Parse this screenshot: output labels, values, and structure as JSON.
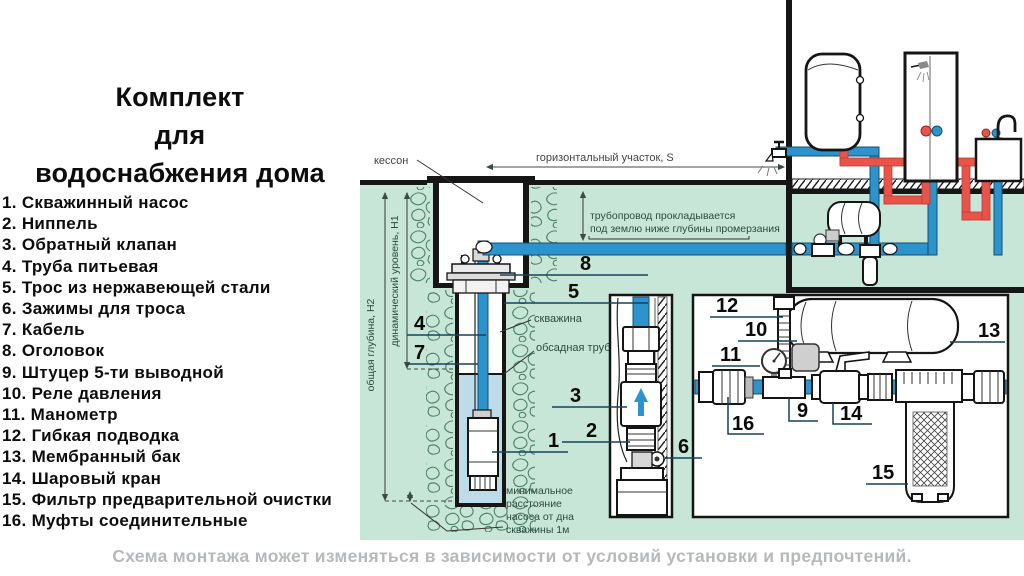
{
  "title_lines": [
    "Комплект",
    "для",
    "водоснабжения дома"
  ],
  "parts": [
    {
      "num": "1.",
      "label": "Скважинный насос"
    },
    {
      "num": "2.",
      "label": "Ниппель"
    },
    {
      "num": "3.",
      "label": "Обратный клапан"
    },
    {
      "num": "4.",
      "label": "Труба питьевая"
    },
    {
      "num": "5.",
      "label": "Трос из нержавеющей стали"
    },
    {
      "num": "6.",
      "label": "Зажимы для троса"
    },
    {
      "num": "7.",
      "label": "Кабель"
    },
    {
      "num": "8.",
      "label": "Оголовок"
    },
    {
      "num": "9.",
      "label": "Штуцер 5-ти выводной"
    },
    {
      "num": "10.",
      "label": "Реле давления"
    },
    {
      "num": "11.",
      "label": "Манометр"
    },
    {
      "num": "12.",
      "label": "Гибкая подводка"
    },
    {
      "num": "13.",
      "label": "Мембранный бак"
    },
    {
      "num": "14.",
      "label": "Шаровый кран"
    },
    {
      "num": "15.",
      "label": "Фильтр предварительной очистки"
    },
    {
      "num": "16.",
      "label": "Муфты соединительные"
    }
  ],
  "caption": "Схема монтажа может изменяться в зависимости от условий установки и предпочтений.",
  "diagram": {
    "callouts": [
      "1",
      "2",
      "3",
      "4",
      "5",
      "6",
      "7",
      "8",
      "9",
      "10",
      "11",
      "12",
      "13",
      "14",
      "15",
      "16"
    ],
    "labels": {
      "kesson": "кессон",
      "horizontal_section": "горизонтальный участок, S",
      "pipeline_line1": "трубопровод прокладывается",
      "pipeline_line2": "под землю ниже глубины промерзания",
      "total_depth": "общая глубина, H2",
      "dynamic_level": "динамический уровень, H1",
      "well": "скважина",
      "casing_pipe": "обсадная труба",
      "min_distance_line1": "минимальное",
      "min_distance_line2": "расстояние",
      "min_distance_line3": "насоса от дна",
      "min_distance_line4": "скважины 1м"
    }
  },
  "colors": {
    "ground_green": "#c8e6d7",
    "pipe_blue": "#2d93cd",
    "pipe_red": "#e8544a",
    "water_blue": "#bedbe9",
    "caption_gray": "#b5b9bc"
  }
}
